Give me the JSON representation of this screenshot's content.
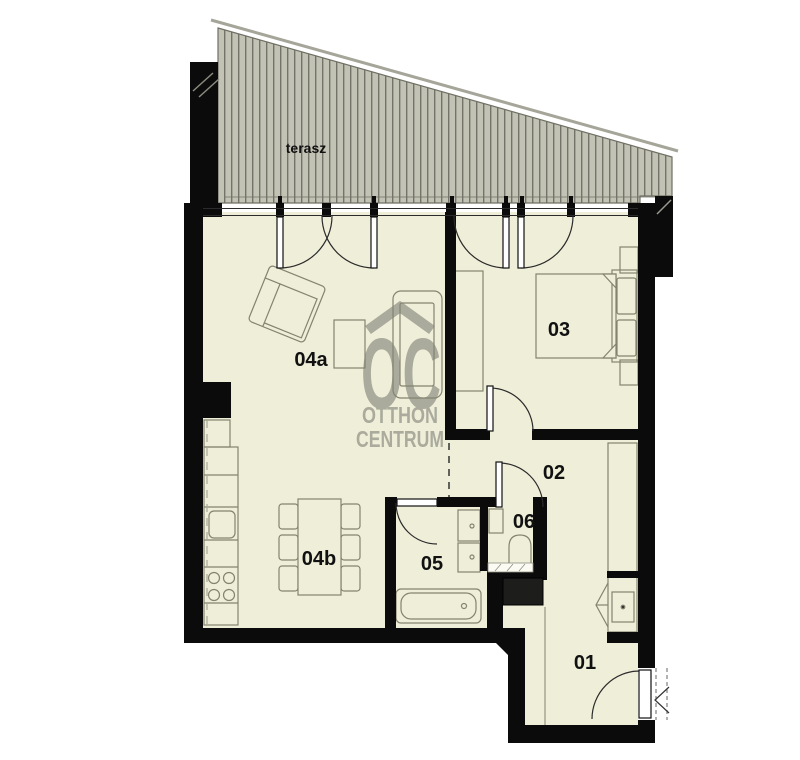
{
  "plan_title": "apartment floor plan",
  "watermark": {
    "monogram": "OC",
    "line1": "OTTHON",
    "line2": "CENTRUM"
  },
  "labels": {
    "terrace": "terasz",
    "room01": "01",
    "room02": "02",
    "room03": "03",
    "room04a": "04a",
    "room04b": "04b",
    "room05": "05",
    "room06": "06"
  },
  "colors": {
    "floor": "#efeed9",
    "terrace_fill": "#c3c3b5",
    "terrace_hatch": "#73736a",
    "wall": "#0b0b0b",
    "furniture_stroke": "#83836f",
    "watermark_gray": "#a8a89a"
  }
}
